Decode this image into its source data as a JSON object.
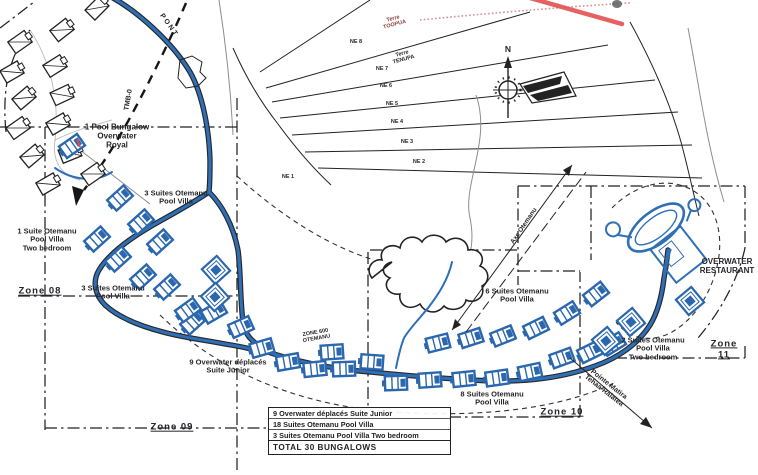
{
  "title": "Resort site plan – Zone 600 Otemanu bungalow implantation",
  "colors": {
    "road_blue": "#2e6fb6",
    "bungalow_blue": "#2a67ae",
    "ink": "#1c1c1c",
    "red_annotation": "#e34c4c",
    "red_dotted": "#d88f8f",
    "terre_text_red": "#8a4038"
  },
  "legend": {
    "rows": [
      "9 Overwater déplacés Suite Junior",
      "18 Suites Otemanu Pool Villa",
      "3 Suites Otemanu Pool Villa Two bedroom"
    ],
    "total": "TOTAL 30 BUNGALOWS"
  },
  "plan": {
    "labels": [
      {
        "id": "pool-bungalow-royal",
        "text": "1 Pool Bungalow\nOverwater\nRoyal",
        "x": 117,
        "y": 137,
        "size": 8
      },
      {
        "id": "suites-otemanu-3-top",
        "text": "3 Suites Otemanu\nPool Villa",
        "x": 176,
        "y": 198,
        "size": 7.5
      },
      {
        "id": "suite-otemanu-1-two-bedroom",
        "text": "1 Suite Otemanu\nPool Villa\nTwo bedroom",
        "x": 47,
        "y": 240,
        "size": 7.5
      },
      {
        "id": "zone-08",
        "text": "Zone 08",
        "x": 40,
        "y": 292,
        "size": 9.5,
        "u": 1
      },
      {
        "id": "suites-otemanu-3-mid",
        "text": "3 Suites Otemanu\nPool Villa",
        "x": 113,
        "y": 293,
        "size": 7.5
      },
      {
        "id": "overwater-deplaces-9",
        "text": "9 Overwater déplacés\nSuite Junior",
        "x": 228,
        "y": 367,
        "size": 7.5
      },
      {
        "id": "zone-600-otemanu",
        "text": "ZONE 600\nOTEMANU",
        "x": 316,
        "y": 336,
        "size": 5.5,
        "rot": -10
      },
      {
        "id": "zone-09",
        "text": "Zone 09",
        "x": 172,
        "y": 428,
        "size": 9.5,
        "u": 1
      },
      {
        "id": "suites-otemanu-6",
        "text": "6 Suites Otemanu\nPool Villa",
        "x": 517,
        "y": 296,
        "size": 7.5
      },
      {
        "id": "suites-otemanu-8",
        "text": "8 Suites Otemanu\nPool Villa",
        "x": 492,
        "y": 399,
        "size": 7.5
      },
      {
        "id": "zone-10",
        "text": "Zone 10",
        "x": 562,
        "y": 413,
        "size": 9.5,
        "u": 1
      },
      {
        "id": "suites-otemanu-2-two-bedroom",
        "text": "2 Suites Otemanu\nPool Villa\nTwo bedroom",
        "x": 653,
        "y": 349,
        "size": 7.5
      },
      {
        "id": "zone-11",
        "text": "Zone 11",
        "x": 724,
        "y": 350,
        "size": 9.5,
        "u": 1
      },
      {
        "id": "overwater-restaurant",
        "text": "OVERWATER\nRESTAURANT",
        "x": 727,
        "y": 267,
        "size": 8
      },
      {
        "id": "pointe-matira",
        "text": "Pointe Matira\nTehaa-Raiatea",
        "x": 606,
        "y": 388,
        "size": 7,
        "rot": 38
      },
      {
        "id": "axe-otemanu",
        "text": "Axe Otemanu",
        "x": 524,
        "y": 226,
        "size": 6.5,
        "rot": -56
      },
      {
        "id": "pont",
        "text": "P O N T",
        "x": 168,
        "y": 25,
        "size": 7,
        "rot": 55
      },
      {
        "id": "tmb-0",
        "text": "TMB-0",
        "x": 129,
        "y": 100,
        "size": 7,
        "rot": -80
      },
      {
        "id": "terre-toopua",
        "text": "Terre\nTOOPUA",
        "x": 394,
        "y": 22,
        "size": 5.5,
        "rot": -15,
        "color": "#8a4038"
      },
      {
        "id": "terre-tenupa",
        "text": "Terre\nTENUPA",
        "x": 403,
        "y": 57,
        "size": 5.5,
        "rot": -15
      },
      {
        "id": "compass-north",
        "text": "N",
        "x": 508,
        "y": 50,
        "size": 8.5
      },
      {
        "id": "parcel-ne-8",
        "text": "NE 8",
        "x": 356,
        "y": 42,
        "size": 5.5
      },
      {
        "id": "parcel-ne-7",
        "text": "NE 7",
        "x": 382,
        "y": 69,
        "size": 5.5
      },
      {
        "id": "parcel-ne-6",
        "text": "NE 6",
        "x": 386,
        "y": 86,
        "size": 5.5
      },
      {
        "id": "parcel-ne-5",
        "text": "NE 5",
        "x": 392,
        "y": 104,
        "size": 5.5
      },
      {
        "id": "parcel-ne-4",
        "text": "NE 4",
        "x": 397,
        "y": 122,
        "size": 5.5
      },
      {
        "id": "parcel-ne-3",
        "text": "NE 3",
        "x": 407,
        "y": 142,
        "size": 5.5
      },
      {
        "id": "parcel-ne-2",
        "text": "NE 2",
        "x": 419,
        "y": 162,
        "size": 5.5
      },
      {
        "id": "parcel-ne-1",
        "text": "NE 1",
        "x": 288,
        "y": 177,
        "size": 5.5
      }
    ],
    "bungalows": {
      "black": [
        [
          20,
          42,
          -35
        ],
        [
          62,
          30,
          -38
        ],
        [
          12,
          72,
          -30
        ],
        [
          55,
          66,
          -32
        ],
        [
          24,
          98,
          -40
        ],
        [
          62,
          95,
          -25
        ],
        [
          18,
          128,
          -35
        ],
        [
          58,
          124,
          -30
        ],
        [
          32,
          156,
          -40
        ],
        [
          70,
          153,
          -22
        ],
        [
          48,
          184,
          -30
        ],
        [
          93,
          174,
          -35
        ],
        [
          97,
          8,
          -45
        ]
      ],
      "village_blue": [
        [
          72,
          146,
          -35
        ]
      ],
      "blue": [
        [
          120,
          198,
          -42
        ],
        [
          141,
          222,
          -42
        ],
        [
          97,
          239,
          -42
        ],
        [
          118,
          259,
          -42
        ],
        [
          160,
          242,
          -42
        ],
        [
          143,
          277,
          -42
        ],
        [
          167,
          287,
          -42
        ],
        [
          193,
          322,
          -42
        ],
        [
          188,
          310,
          -36
        ],
        [
          214,
          312,
          -30
        ],
        [
          241,
          327,
          -24
        ],
        [
          262,
          348,
          -16
        ],
        [
          288,
          362,
          -10
        ],
        [
          315,
          369,
          -6
        ],
        [
          344,
          369,
          -2
        ],
        [
          372,
          362,
          4
        ],
        [
          332,
          352,
          -4
        ],
        [
          438,
          343,
          -14
        ],
        [
          471,
          338,
          -18
        ],
        [
          503,
          336,
          -22
        ],
        [
          536,
          328,
          -26
        ],
        [
          567,
          313,
          -32
        ],
        [
          596,
          294,
          -38
        ],
        [
          396,
          383,
          -2
        ],
        [
          430,
          380,
          -4
        ],
        [
          464,
          379,
          -6
        ],
        [
          497,
          378,
          -8
        ],
        [
          530,
          372,
          -12
        ],
        [
          562,
          358,
          -20
        ],
        [
          590,
          352,
          -26
        ],
        [
          613,
          344,
          -32
        ]
      ],
      "blue_square": [
        [
          216,
          270,
          -42
        ],
        [
          215,
          297,
          -42
        ],
        [
          631,
          322,
          -40
        ],
        [
          606,
          341,
          -40
        ],
        [
          690,
          301,
          -40
        ]
      ]
    },
    "compass": {
      "x": 508,
      "y": 90,
      "label": "N"
    }
  }
}
